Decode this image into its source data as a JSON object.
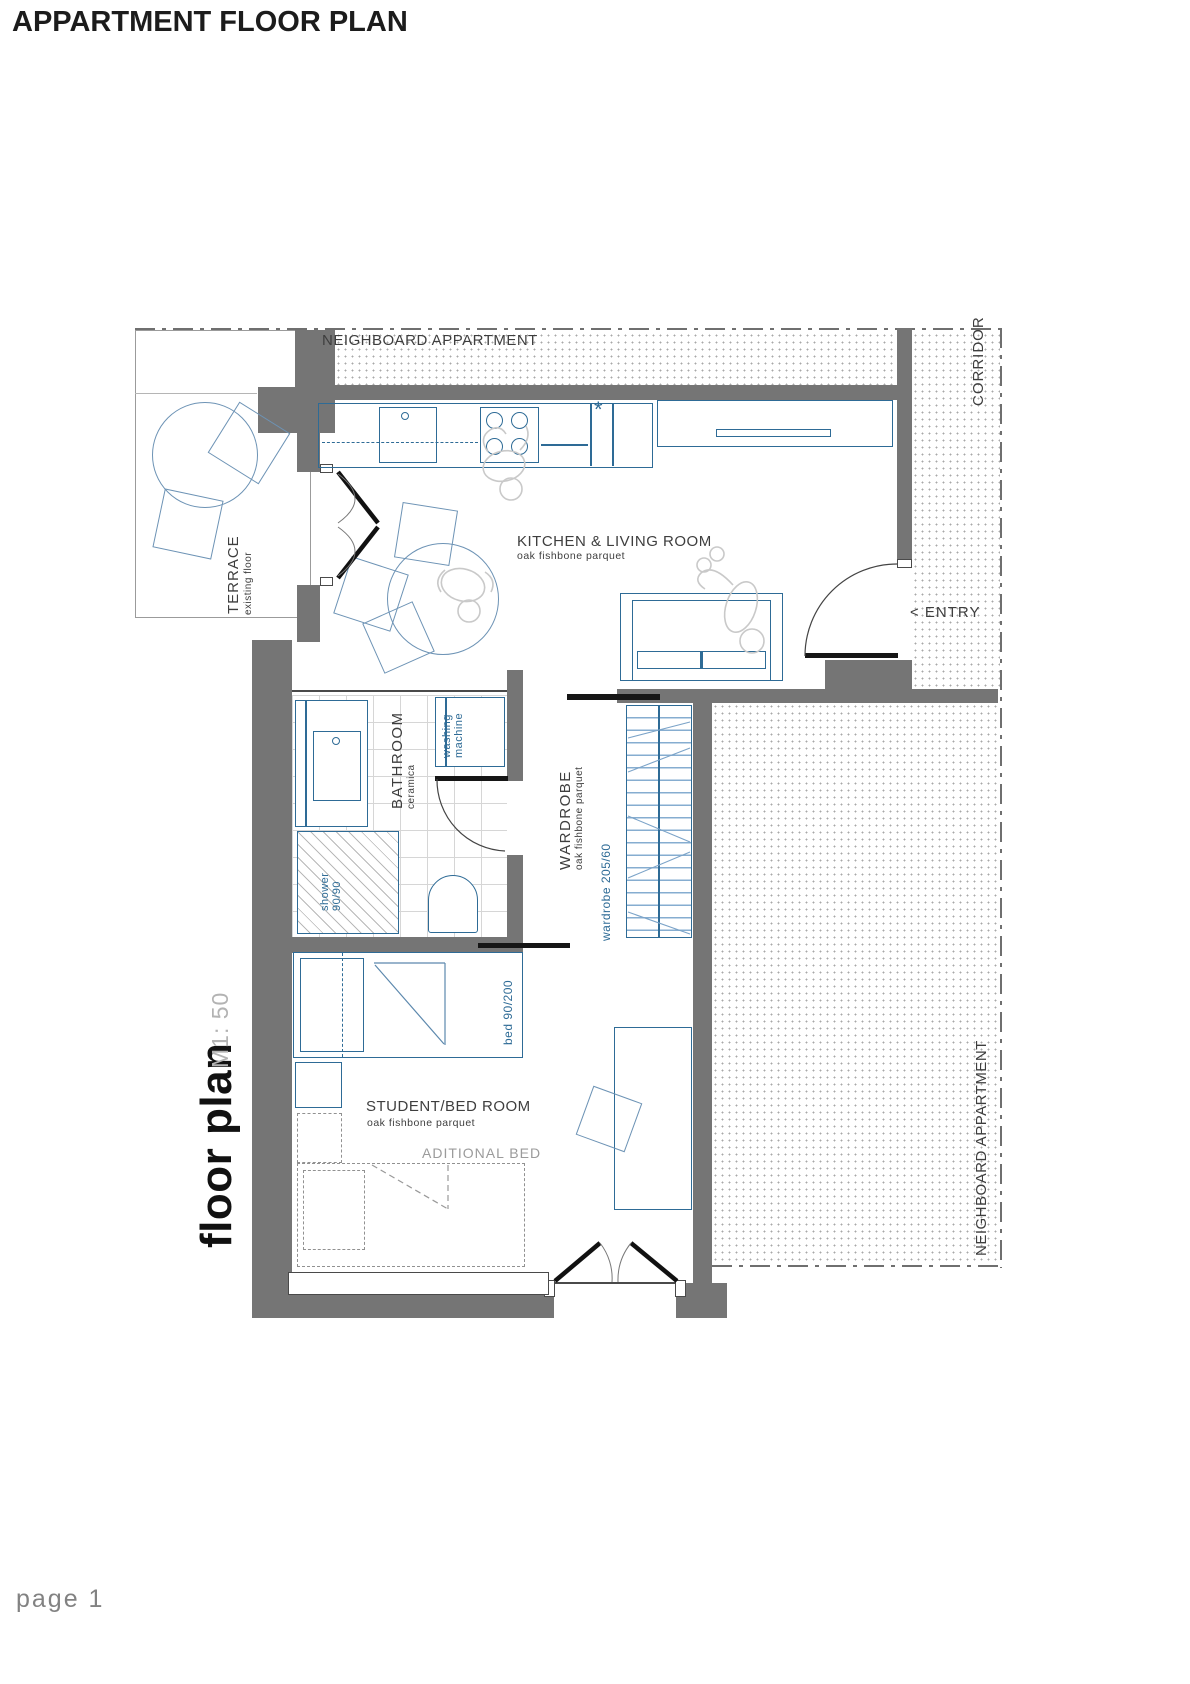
{
  "page": {
    "title": "APPARTMENT FLOOR PLAN",
    "footer": "page 1",
    "drawing_title": "floor plan",
    "scale": "M1: 50"
  },
  "context": {
    "neighbor_top": "NEIGHBOARD APPARTMENT",
    "neighbor_right": "NEIGHBOARD APPARTMENT",
    "corridor": "CORRIDOR",
    "entry": "< ENTRY"
  },
  "rooms": {
    "kitchen_living": {
      "name": "KITCHEN & LIVING ROOM",
      "floor": "oak fishbone parquet"
    },
    "terrace": {
      "name": "TERRACE",
      "floor": "existing floor"
    },
    "bathroom": {
      "name": "BATHROOM",
      "floor": "ceramica"
    },
    "wardrobe": {
      "name": "WARDROBE",
      "floor": "oak fishbone parquet",
      "dim": "wardrobe 205/60"
    },
    "bedroom": {
      "name": "STUDENT/BED ROOM",
      "floor": "oak fishbone parquet"
    }
  },
  "fixtures": {
    "washing_machine_line1": "washing",
    "washing_machine_line2": "machine",
    "shower_line1": "shower",
    "shower_line2": "90/90",
    "bed_dim": "bed 90/200",
    "additional_bed": "ADITIONAL BED",
    "freezer_symbol": "*"
  },
  "colors": {
    "wall": "#757575",
    "fixture_blue": "#2e6b96",
    "light_blue": "#6d93b5",
    "sketch_gray": "#c9c9c9",
    "lintel_black": "#161616"
  }
}
